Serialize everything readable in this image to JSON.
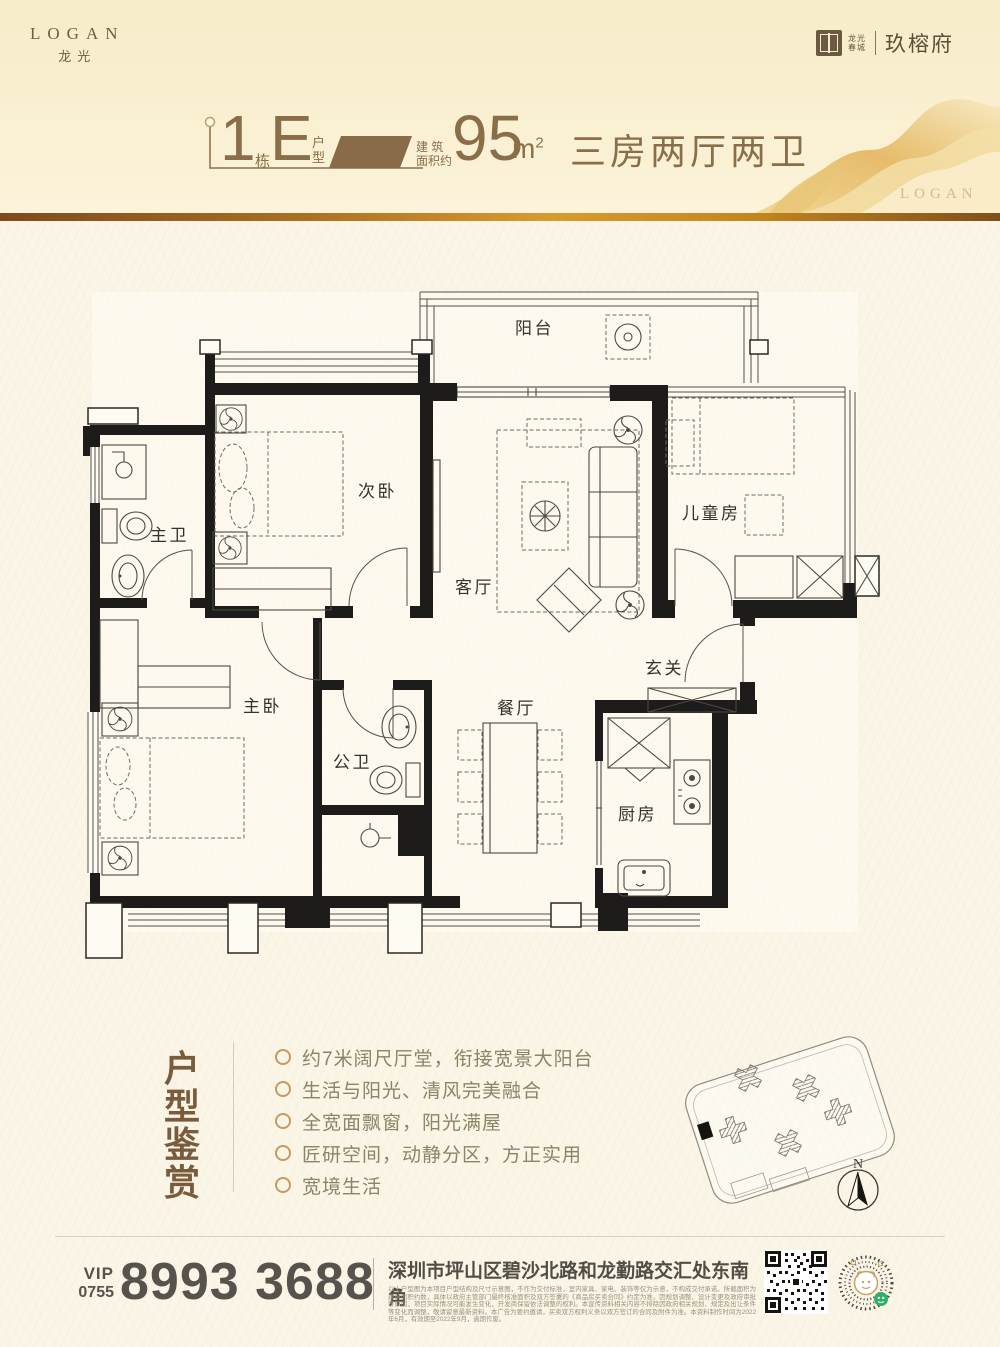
{
  "brand": {
    "name": "LOGAN",
    "name_cn": "龙光",
    "seal_line1": "龙光",
    "seal_line2": "春城",
    "project": "玖榕府",
    "watermark": "LOGAN"
  },
  "title": {
    "block_num": "1",
    "block_suffix": "栋",
    "unit": "E",
    "unit_suffix_1": "户",
    "unit_suffix_2": "型",
    "area_label_1": "建 筑",
    "area_label_2": "面积约",
    "area_value": "95",
    "area_unit": "m",
    "area_sup": "2",
    "layout": "三房两厅两卫"
  },
  "floorplan": {
    "rooms": [
      "阳台",
      "次卧",
      "主卫",
      "客厅",
      "儿童房",
      "玄关",
      "主卧",
      "公卫",
      "餐厅",
      "厨房"
    ]
  },
  "features": {
    "heading": [
      "户",
      "型",
      "鉴",
      "赏"
    ],
    "items": [
      "约7米阔尺厅堂，衔接宽景大阳台",
      "生活与阳光、清风完美融合",
      "全宽面飘窗，阳光满屋",
      "匠研空间，动静分区，方正实用",
      "宽境生活"
    ]
  },
  "siteplan": {
    "north": "N"
  },
  "contact": {
    "vip": "VIP",
    "area_code": "0755",
    "phone": "8993 3688",
    "address": "深圳市坪山区碧沙北路和龙勤路交汇处东南角",
    "disclaimer": "以上户型图为本项目户型结构及尺寸示意图，不作为交付标准，室内家具、家电、装饰等仅为示意，不构成交付承诺。所载面积为建筑面积约数，具体以政府主管部门最终核准面积及双方签署的《商品房买卖合同》约定为准。因规划调整、设计变更及政府审批等原因，项目实际情况可能发生变化，开发商保留依法调整的权利。本宣传资料相关内容不排除因政府相关规划、规定及出让条件等变化而调整，敬请留意最新资料。本广告为要约邀请，买卖双方权利义务以双方签订的合同及附件为准。本资料制作时间为2022年6月，有效期至2022年9月，逾期作废。"
  },
  "colors": {
    "accent_brown": "#8a6e48",
    "divider_gold": "#d99b2f",
    "wall_black": "#1d1c1a"
  }
}
